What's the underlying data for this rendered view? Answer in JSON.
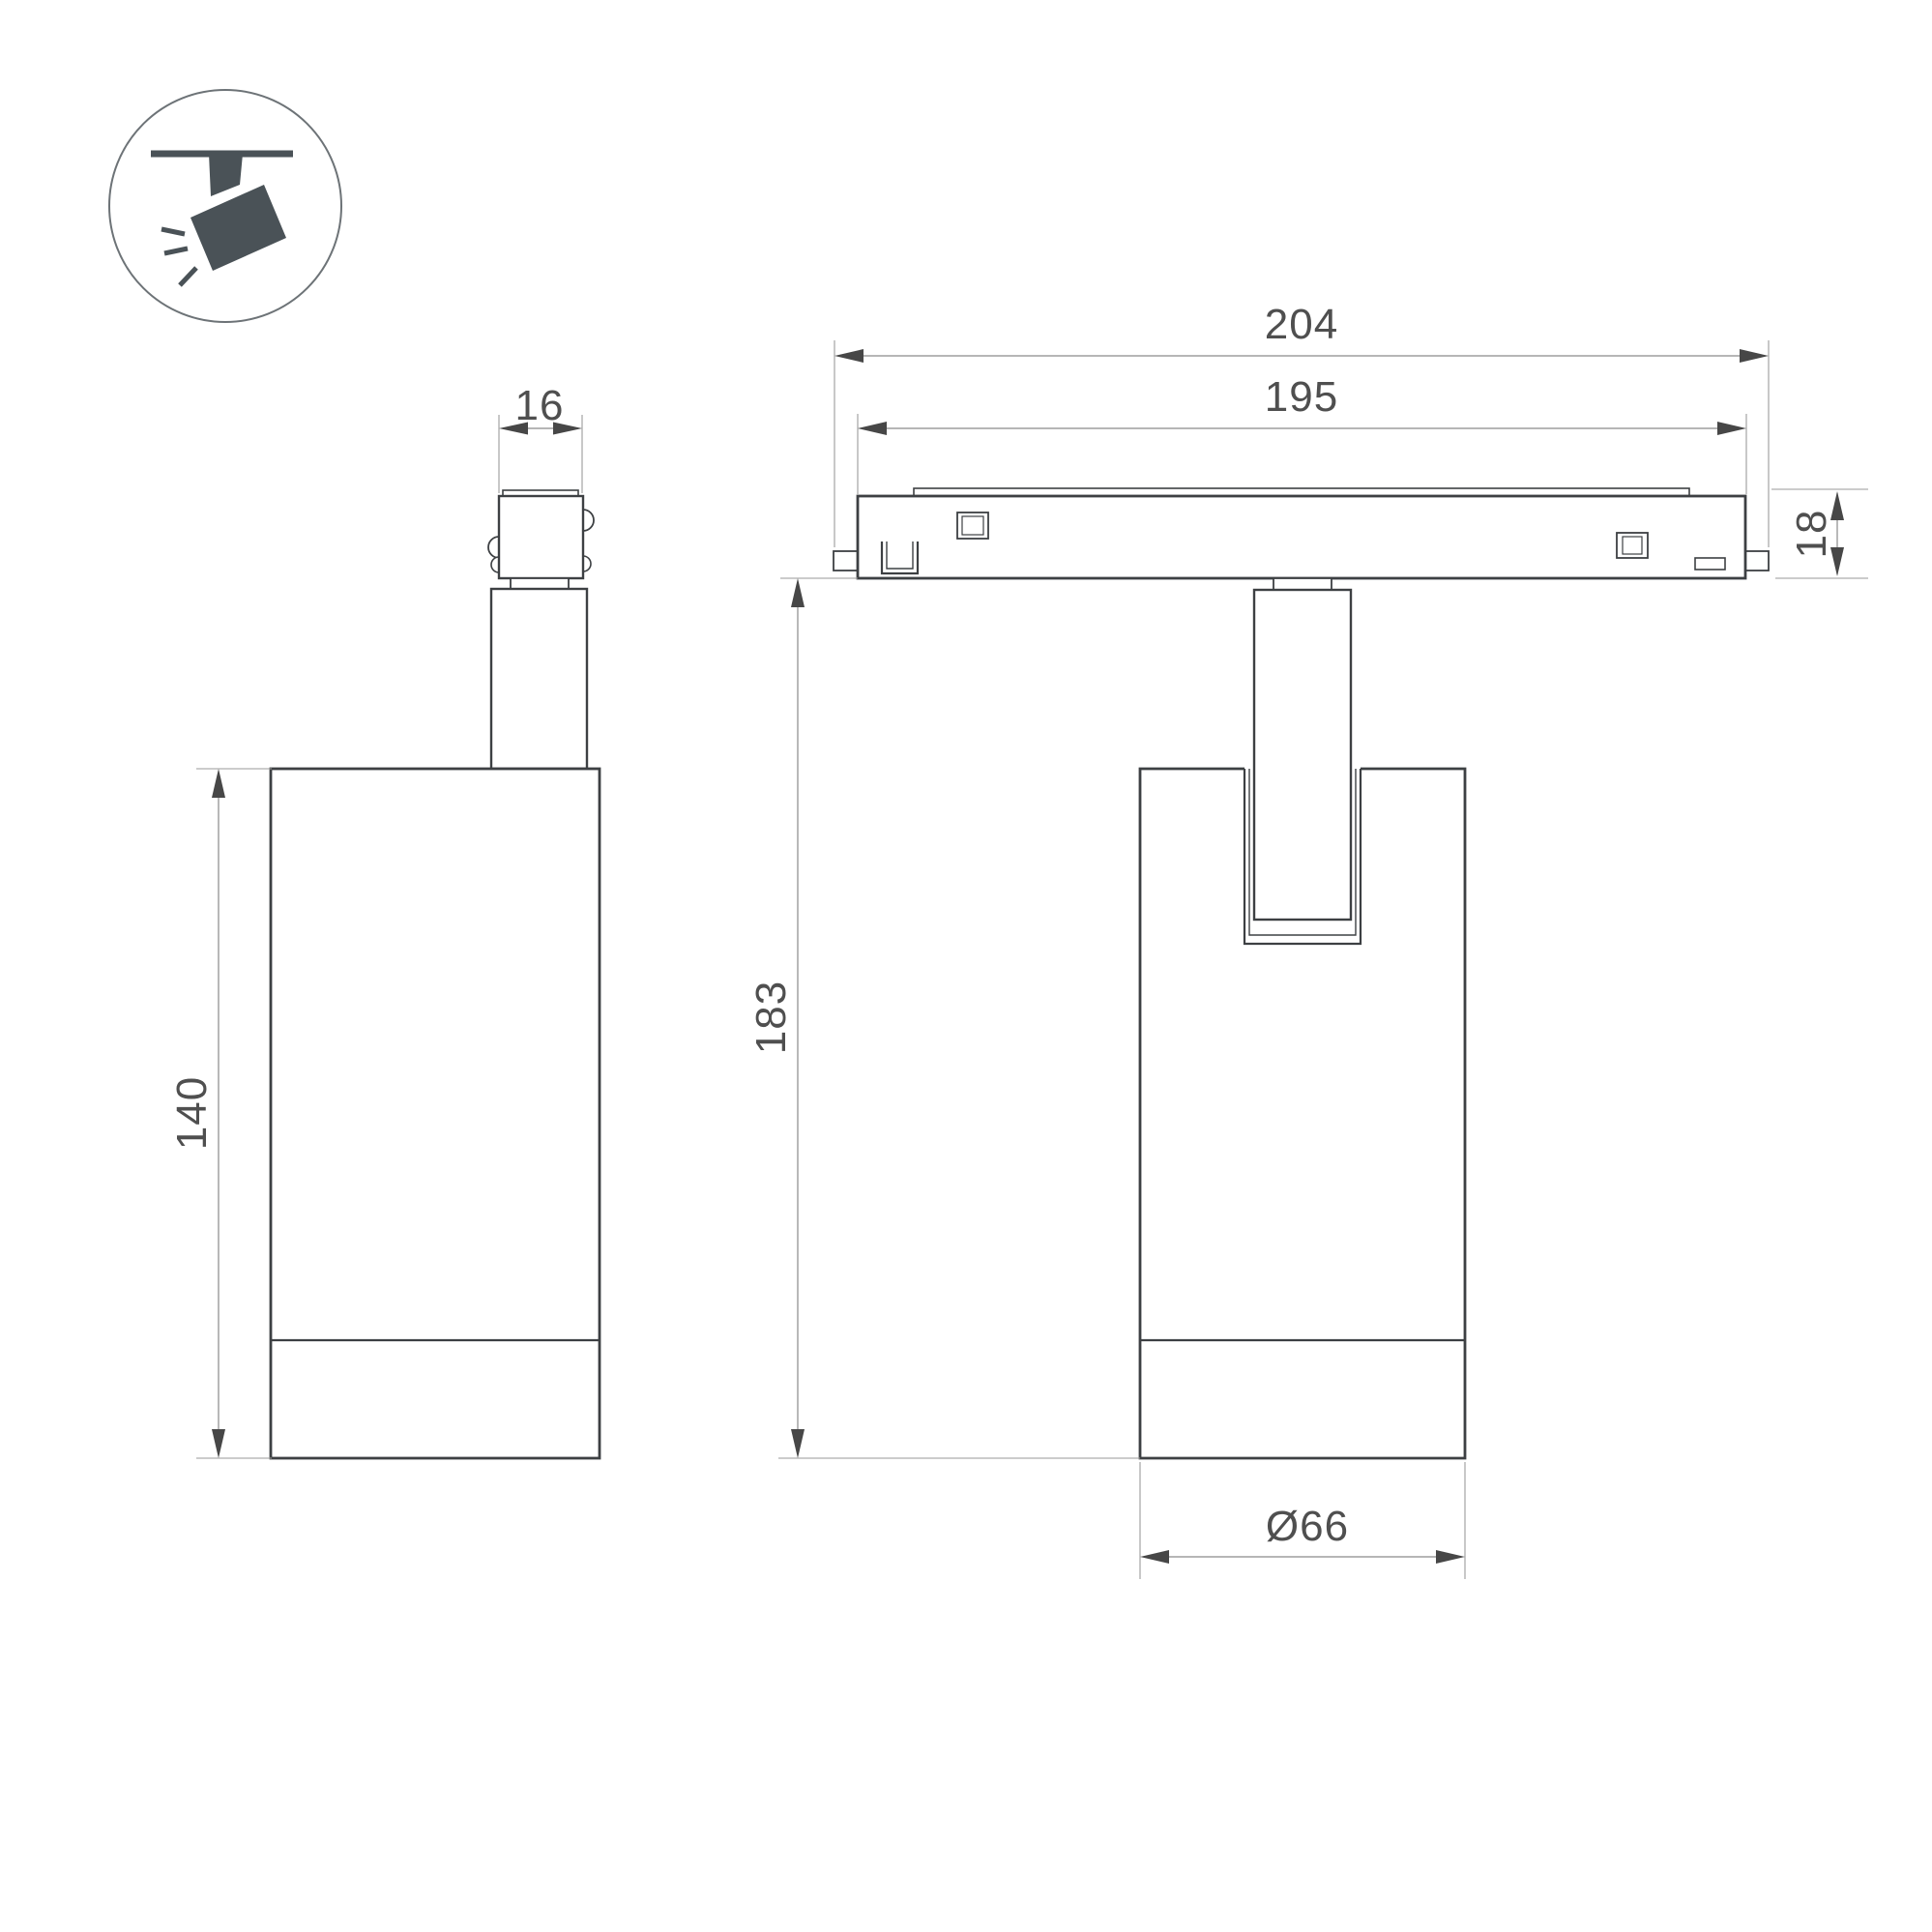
{
  "drawing": {
    "kind": "luminaire-dimension-drawing",
    "icon": {
      "name": "ceiling-track-spotlight-icon"
    },
    "colors": {
      "object_line": "#3d4043",
      "dimension_line": "#8a8a8a",
      "extension_line": "#9a9a9a",
      "arrow": "#474747",
      "text": "#4f4f4f",
      "icon_glyph": "#4a5257",
      "icon_circle_stroke": "#6d7377",
      "background": "#ffffff"
    },
    "views": {
      "side_view_name": "side-view",
      "front_view_name": "front-view-with-track"
    },
    "dimensions": {
      "adapter_width": "16",
      "body_height": "140",
      "track_outer_length": "204",
      "track_inner_length": "195",
      "track_height": "18",
      "overall_height": "183",
      "body_diameter": "Ø66"
    }
  }
}
